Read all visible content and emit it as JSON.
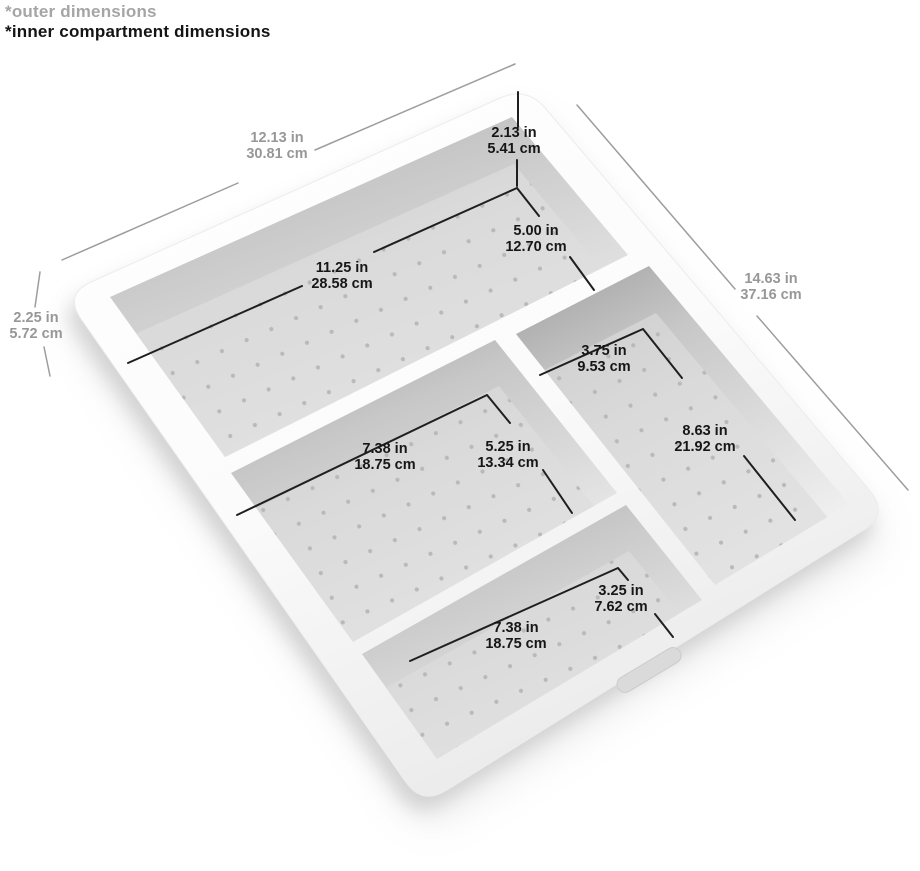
{
  "legend": {
    "outer_note": "*outer dimensions",
    "inner_note": "*inner compartment dimensions"
  },
  "dimensions": {
    "outer_width": {
      "in": "12.13 in",
      "cm": "30.81 cm",
      "type": "outer"
    },
    "outer_length": {
      "in": "14.63 in",
      "cm": "37.16 cm",
      "type": "outer"
    },
    "outer_height": {
      "in": "2.25 in",
      "cm": "5.72 cm",
      "type": "outer"
    },
    "inner_depth": {
      "in": "2.13 in",
      "cm": "5.41 cm",
      "type": "inner"
    },
    "top_compartment_length": {
      "in": "5.00 in",
      "cm": "12.70 cm",
      "type": "inner"
    },
    "top_compartment_width": {
      "in": "11.25 in",
      "cm": "28.58 cm",
      "type": "inner"
    },
    "right_compartment_width": {
      "in": "3.75 in",
      "cm": "9.53 cm",
      "type": "inner"
    },
    "right_compartment_length": {
      "in": "8.63 in",
      "cm": "21.92 cm",
      "type": "inner"
    },
    "middle_compartment_width": {
      "in": "7.38 in",
      "cm": "18.75 cm",
      "type": "inner"
    },
    "middle_compartment_length": {
      "in": "5.25 in",
      "cm": "13.34 cm",
      "type": "inner"
    },
    "bottom_compartment_length": {
      "in": "3.25 in",
      "cm": "7.62 cm",
      "type": "inner"
    },
    "bottom_compartment_width": {
      "in": "7.38 in",
      "cm": "18.75 cm",
      "type": "inner"
    }
  },
  "colors": {
    "inner_dimension_text": "#161616",
    "outer_dimension_text": "#979797",
    "inner_dimension_line": "#1f1f1f",
    "outer_dimension_line": "#9d9d9d",
    "tray_body": "#fafafa",
    "compartment_floor": "#dbdbdb",
    "floor_dots": "#b9b9b9"
  }
}
